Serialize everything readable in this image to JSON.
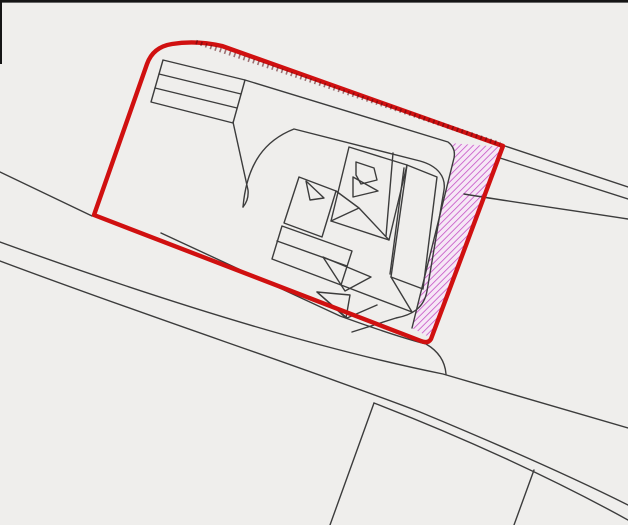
{
  "page": {
    "type": "site-location-plan",
    "description": "Monochrome map line-work with red site boundary and magenta hatched transfer area"
  },
  "colors": {
    "background": "#efeeec",
    "line_black": "#3c3c3c",
    "boundary_red": "#d01010",
    "tick_dark": "#55080d",
    "hatch_magenta": "#c95fc9",
    "hatch_tint": "#f6e7f6",
    "border_black": "#151515"
  },
  "geometry": {
    "border_top": "M0,0 H628 V2.6 H0 Z",
    "border_left": "M0,0 V64 H2 V0 Z",
    "road_nw": "M0,172 L92,216",
    "parcel_south": "M161,233 L340,316 Q398,337 426,344 C438,351 445,361 446,374",
    "road_main_upper": "M0,242 C160,300 310,347 443,374 L628,428",
    "road_main_lower": "M0,261 C160,321 300,366 420,412 C490,441 572,477 628,505",
    "road_lower_edge": "M374,403 C460,436 552,478 628,520",
    "plot_line_west": "M374,403 L330,525",
    "plot_line_east": "M534,470 L514,525",
    "road_ne_upper": "M505,146 L628,187",
    "road_ne_lower": "M500,158 L628,199",
    "road_ne_curve": "M464,194 C512,202 570,210 628,219",
    "site_boundary": "M94,215 L147,64 Q153,47 172,44 Q196,40 222,46 L503,146 L431,339 Q428,344 421,341 Z",
    "boundary_ticks": "M196,42 L500,144",
    "transfer_area": "M449,143 L503,147 L431,338 L412,328 L454,158 Q456,148 449,143 Z",
    "strip_building": "M163,60 L245,80 L233,123 L151,102 Z",
    "strip_div_1": "M159,74 L241,94",
    "strip_div_2": "M155,88 L237,108",
    "strip_connector": "M233,122 L248,190 Q249,200 243,207",
    "courtyard_loop": "M243,207 C247,162 266,140 294,129 L420,161 C438,166 446,177 444,190 L427,291 C424,308 412,315 396,318 L352,332",
    "parcel_north": "M245,80 L448,142 Q456,148 454,158 L412,328",
    "bldg_upper": "M349,147 L407,165 L389,240 L331,221 Z",
    "bldg_upper_div": "M393,153 L386,236",
    "bldg_bay": "M356,162 L374,168 L377,180 L361,184 L356,175 Z",
    "bldg_arrow": "M353,177 L378,191 L353,197 Z",
    "bldg_right": "M407,165 L437,177 L423,289 L391,277 Z",
    "bldg_right_div": "M404,168 L390,274",
    "bldg_left": "M299,177 L336,191 L322,237 L284,223 Z",
    "bldg_notch": "M306,181 L324,198 L310,200 Z",
    "bldg_zigzag": "M336,191 L359,208 L331,221 M359,208 L389,240",
    "bldg_lower": "M282,226 L352,251 L341,285 L272,259 Z",
    "bldg_lower_div": "M277,241 L347,266",
    "bldg_gable_1": "M323,257 L371,277 L345,291 Z",
    "bldg_gable_2": "M317,292 L350,295 L346,318 Z",
    "bldg_bottom": "M341,285 L412,312 M377,305 L347,318 L317,292 M391,277 L412,312"
  }
}
